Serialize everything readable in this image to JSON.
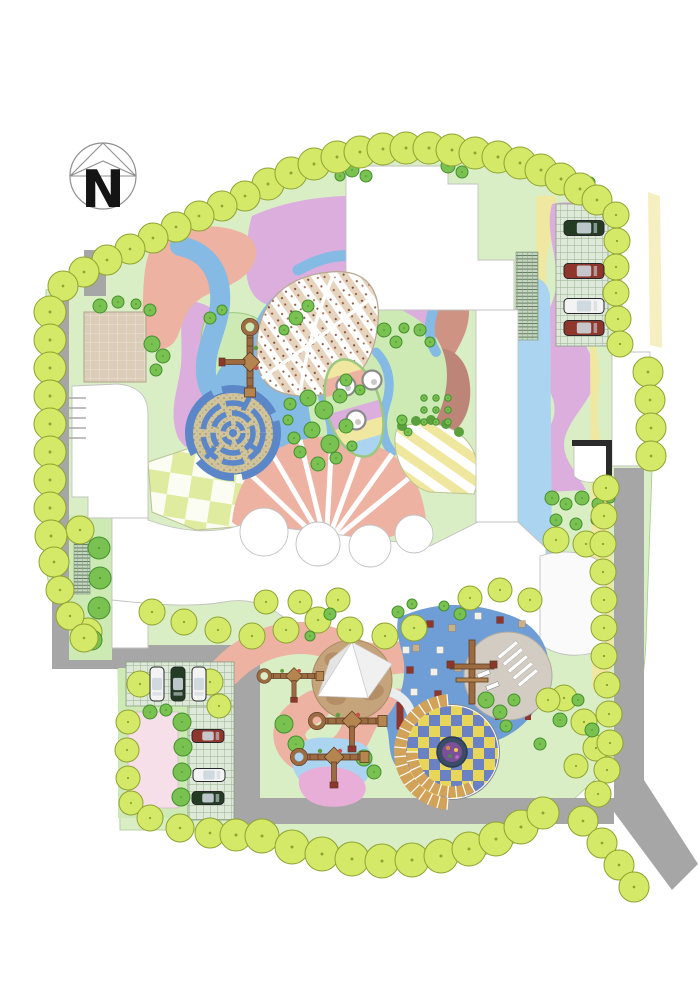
{
  "title": "Kindergarten Landscape Site Plan",
  "compass": {
    "label": "N"
  },
  "palette": {
    "bg": "#ffffff",
    "road": "#a6a6a6",
    "lawn": "#d9eec5",
    "lawn_bright": "#cdeab4",
    "lawn_edge": "#9cc87f",
    "tree_yellow": "#d4e967",
    "tree_yellow_stroke": "#8fa233",
    "tree_green": "#79c150",
    "tree_green_stroke": "#45902f",
    "salmon": "#edb2a2",
    "brick": "#cf9384",
    "mauve": "#bd8478",
    "plum": "#dcaede",
    "blue_light": "#abd4f0",
    "blue_path": "#84bae4",
    "maze_blue": "#5b86c8",
    "maze_ground": "#d0c49c",
    "rubber_blue": "#6f9ed7",
    "yellow": "#f0e7a1",
    "yellow_pale": "#f5efc2",
    "tan": "#dccdb8",
    "sand": "#c6a47b",
    "sand_dark": "#a9835b",
    "step_tan": "#d2a259",
    "gray_plaza": "#d3ccc2",
    "car_red": "#8e352c",
    "car_green": "#243c24",
    "car_white": "#f3f3f3",
    "wood": "#9c6b42",
    "wood_dark": "#5f3d22",
    "pink_pocket": "#e9aed8",
    "pink_plaza": "#f6dfe9",
    "white": "#ffffff"
  },
  "planting": {
    "boundary_trees": [
      [
        268,
        184,
        16
      ],
      [
        291,
        173,
        16
      ],
      [
        314,
        164,
        16
      ],
      [
        337,
        157,
        16
      ],
      [
        360,
        152,
        16
      ],
      [
        383,
        149,
        16
      ],
      [
        406,
        148,
        16
      ],
      [
        429,
        148,
        16
      ],
      [
        452,
        150,
        16
      ],
      [
        475,
        153,
        16
      ],
      [
        498,
        157,
        16
      ],
      [
        520,
        163,
        16
      ],
      [
        541,
        170,
        16
      ],
      [
        561,
        179,
        16
      ],
      [
        580,
        189,
        16
      ],
      [
        597,
        200,
        15
      ],
      [
        616,
        215,
        13
      ],
      [
        617,
        241,
        13
      ],
      [
        616,
        267,
        13
      ],
      [
        616,
        293,
        13
      ],
      [
        618,
        319,
        13
      ],
      [
        620,
        344,
        13
      ],
      [
        245,
        196,
        15
      ],
      [
        222,
        206,
        15
      ],
      [
        199,
        216,
        15
      ],
      [
        176,
        227,
        15
      ],
      [
        153,
        238,
        15
      ],
      [
        130,
        249,
        15
      ],
      [
        107,
        260,
        15
      ],
      [
        84,
        272,
        15
      ],
      [
        63,
        286,
        15
      ],
      [
        50,
        312,
        16
      ],
      [
        50,
        340,
        16
      ],
      [
        50,
        368,
        16
      ],
      [
        50,
        396,
        16
      ],
      [
        50,
        424,
        16
      ],
      [
        50,
        452,
        16
      ],
      [
        50,
        480,
        16
      ],
      [
        50,
        508,
        16
      ],
      [
        51,
        536,
        16
      ],
      [
        54,
        562,
        15
      ],
      [
        60,
        590,
        14
      ],
      [
        70,
        616,
        14
      ],
      [
        84,
        638,
        14
      ],
      [
        140,
        684,
        13
      ],
      [
        210,
        682,
        13
      ],
      [
        219,
        706,
        12
      ],
      [
        128,
        722,
        12
      ],
      [
        127,
        750,
        12
      ],
      [
        128,
        778,
        12
      ],
      [
        131,
        803,
        12
      ],
      [
        150,
        818,
        13
      ],
      [
        180,
        828,
        14
      ],
      [
        210,
        833,
        15
      ],
      [
        236,
        835,
        16
      ],
      [
        262,
        836,
        17
      ],
      [
        292,
        847,
        17
      ],
      [
        322,
        854,
        17
      ],
      [
        352,
        859,
        17
      ],
      [
        382,
        861,
        17
      ],
      [
        412,
        860,
        17
      ],
      [
        441,
        856,
        17
      ],
      [
        469,
        849,
        17
      ],
      [
        496,
        839,
        17
      ],
      [
        521,
        827,
        17
      ],
      [
        543,
        813,
        16
      ],
      [
        583,
        821,
        15
      ],
      [
        602,
        843,
        15
      ],
      [
        619,
        865,
        15
      ],
      [
        634,
        887,
        15
      ],
      [
        648,
        372,
        15
      ],
      [
        650,
        400,
        15
      ],
      [
        651,
        428,
        15
      ],
      [
        651,
        456,
        15
      ],
      [
        606,
        488,
        13
      ],
      [
        604,
        516,
        13
      ],
      [
        603,
        544,
        13
      ],
      [
        603,
        572,
        13
      ],
      [
        604,
        600,
        13
      ],
      [
        604,
        628,
        13
      ],
      [
        604,
        656,
        13
      ],
      [
        607,
        685,
        13
      ],
      [
        609,
        714,
        13
      ],
      [
        610,
        743,
        13
      ],
      [
        607,
        770,
        13
      ],
      [
        598,
        794,
        13
      ]
    ],
    "lawn_trees": [
      [
        152,
        612,
        13
      ],
      [
        184,
        622,
        13
      ],
      [
        218,
        630,
        13
      ],
      [
        252,
        636,
        13
      ],
      [
        286,
        630,
        13
      ],
      [
        318,
        620,
        13
      ],
      [
        350,
        630,
        13
      ],
      [
        385,
        636,
        13
      ],
      [
        414,
        628,
        13
      ],
      [
        300,
        602,
        12
      ],
      [
        338,
        600,
        12
      ],
      [
        266,
        602,
        12
      ],
      [
        564,
        698,
        13
      ],
      [
        584,
        722,
        13
      ],
      [
        596,
        748,
        13
      ],
      [
        576,
        766,
        12
      ],
      [
        548,
        700,
        12
      ],
      [
        556,
        540,
        13
      ],
      [
        586,
        544,
        13
      ],
      [
        470,
        598,
        12
      ],
      [
        500,
        590,
        12
      ],
      [
        530,
        600,
        12
      ],
      [
        80,
        530,
        14
      ],
      [
        88,
        632,
        14
      ]
    ],
    "shrubs": [
      [
        352,
        170,
        7
      ],
      [
        366,
        176,
        6
      ],
      [
        340,
        176,
        5
      ],
      [
        448,
        166,
        7
      ],
      [
        462,
        172,
        6
      ],
      [
        560,
        188,
        7
      ],
      [
        576,
        196,
        6
      ],
      [
        590,
        182,
        5
      ],
      [
        152,
        344,
        8
      ],
      [
        163,
        356,
        7
      ],
      [
        156,
        370,
        6
      ],
      [
        150,
        310,
        6
      ],
      [
        136,
        304,
        5
      ],
      [
        118,
        302,
        6
      ],
      [
        100,
        306,
        7
      ],
      [
        210,
        318,
        6
      ],
      [
        222,
        310,
        5
      ],
      [
        296,
        318,
        7
      ],
      [
        308,
        306,
        6
      ],
      [
        284,
        330,
        5
      ],
      [
        384,
        330,
        7
      ],
      [
        396,
        342,
        6
      ],
      [
        404,
        328,
        5
      ],
      [
        308,
        398,
        8
      ],
      [
        324,
        410,
        9
      ],
      [
        340,
        396,
        7
      ],
      [
        312,
        430,
        8
      ],
      [
        330,
        444,
        9
      ],
      [
        346,
        426,
        7
      ],
      [
        300,
        452,
        6
      ],
      [
        318,
        464,
        7
      ],
      [
        336,
        458,
        6
      ],
      [
        352,
        446,
        5
      ],
      [
        346,
        380,
        6
      ],
      [
        360,
        390,
        5
      ],
      [
        420,
        330,
        6
      ],
      [
        430,
        342,
        5
      ],
      [
        424,
        398,
        3.2
      ],
      [
        436,
        398,
        3.2
      ],
      [
        448,
        398,
        3.2
      ],
      [
        424,
        410,
        3.2
      ],
      [
        436,
        410,
        3.2
      ],
      [
        448,
        410,
        3.2
      ],
      [
        424,
        422,
        3.2
      ],
      [
        436,
        422,
        3.2
      ],
      [
        448,
        422,
        3.2
      ],
      [
        552,
        498,
        7
      ],
      [
        566,
        504,
        6
      ],
      [
        582,
        498,
        7
      ],
      [
        598,
        504,
        6
      ],
      [
        610,
        498,
        5
      ],
      [
        556,
        520,
        6
      ],
      [
        576,
        524,
        6
      ],
      [
        596,
        520,
        5
      ],
      [
        290,
        404,
        6
      ],
      [
        288,
        420,
        5
      ],
      [
        294,
        438,
        6
      ],
      [
        486,
        700,
        8
      ],
      [
        500,
        712,
        7
      ],
      [
        514,
        700,
        6
      ],
      [
        506,
        726,
        6
      ],
      [
        560,
        720,
        7
      ],
      [
        578,
        700,
        6
      ],
      [
        592,
        730,
        7
      ],
      [
        540,
        744,
        6
      ],
      [
        284,
        724,
        9
      ],
      [
        296,
        744,
        8
      ],
      [
        364,
        758,
        8
      ],
      [
        374,
        772,
        7
      ],
      [
        398,
        612,
        6
      ],
      [
        412,
        604,
        5
      ],
      [
        460,
        614,
        6
      ],
      [
        444,
        606,
        5
      ],
      [
        330,
        614,
        6
      ],
      [
        310,
        636,
        5
      ],
      [
        99,
        548,
        11
      ],
      [
        100,
        578,
        11
      ],
      [
        99,
        608,
        11
      ],
      [
        92,
        640,
        10
      ],
      [
        150,
        712,
        7
      ],
      [
        166,
        710,
        6
      ],
      [
        182,
        722,
        9
      ],
      [
        183,
        747,
        9
      ],
      [
        182,
        772,
        9
      ],
      [
        181,
        797,
        9
      ],
      [
        402,
        420,
        5
      ],
      [
        408,
        432,
        4
      ]
    ]
  },
  "vehicles": {
    "cars": [
      {
        "x": 584,
        "y": 228,
        "rot": 0,
        "color": "car_green",
        "len": 40,
        "wid": 15
      },
      {
        "x": 584,
        "y": 271,
        "rot": 0,
        "color": "car_red",
        "len": 40,
        "wid": 15
      },
      {
        "x": 584,
        "y": 306,
        "rot": 0,
        "color": "car_white",
        "len": 40,
        "wid": 15
      },
      {
        "x": 584,
        "y": 328,
        "rot": 0,
        "color": "car_red",
        "len": 40,
        "wid": 15
      },
      {
        "x": 157,
        "y": 684,
        "rot": 90,
        "color": "car_white",
        "len": 34,
        "wid": 14
      },
      {
        "x": 178,
        "y": 684,
        "rot": 90,
        "color": "car_green",
        "len": 34,
        "wid": 14
      },
      {
        "x": 199,
        "y": 684,
        "rot": 90,
        "color": "car_white",
        "len": 34,
        "wid": 14
      },
      {
        "x": 208,
        "y": 736,
        "rot": 0,
        "color": "car_red",
        "len": 32,
        "wid": 13
      },
      {
        "x": 209,
        "y": 775,
        "rot": 0,
        "color": "car_white",
        "len": 32,
        "wid": 13
      },
      {
        "x": 208,
        "y": 798,
        "rot": 0,
        "color": "car_green",
        "len": 32,
        "wid": 13
      }
    ]
  },
  "mosaic_tiles": [
    [
      408,
      628,
      "w"
    ],
    [
      430,
      624,
      "r"
    ],
    [
      452,
      628,
      "t"
    ],
    [
      416,
      648,
      "t"
    ],
    [
      440,
      650,
      "w"
    ],
    [
      410,
      670,
      "r"
    ],
    [
      434,
      672,
      "w"
    ],
    [
      458,
      668,
      "t"
    ],
    [
      414,
      692,
      "w"
    ],
    [
      438,
      694,
      "r"
    ],
    [
      420,
      714,
      "t"
    ],
    [
      444,
      716,
      "w"
    ],
    [
      430,
      736,
      "r"
    ],
    [
      452,
      734,
      "t"
    ],
    [
      406,
      650,
      "w"
    ],
    [
      478,
      616,
      "w"
    ],
    [
      500,
      620,
      "r"
    ],
    [
      522,
      624,
      "t"
    ]
  ]
}
